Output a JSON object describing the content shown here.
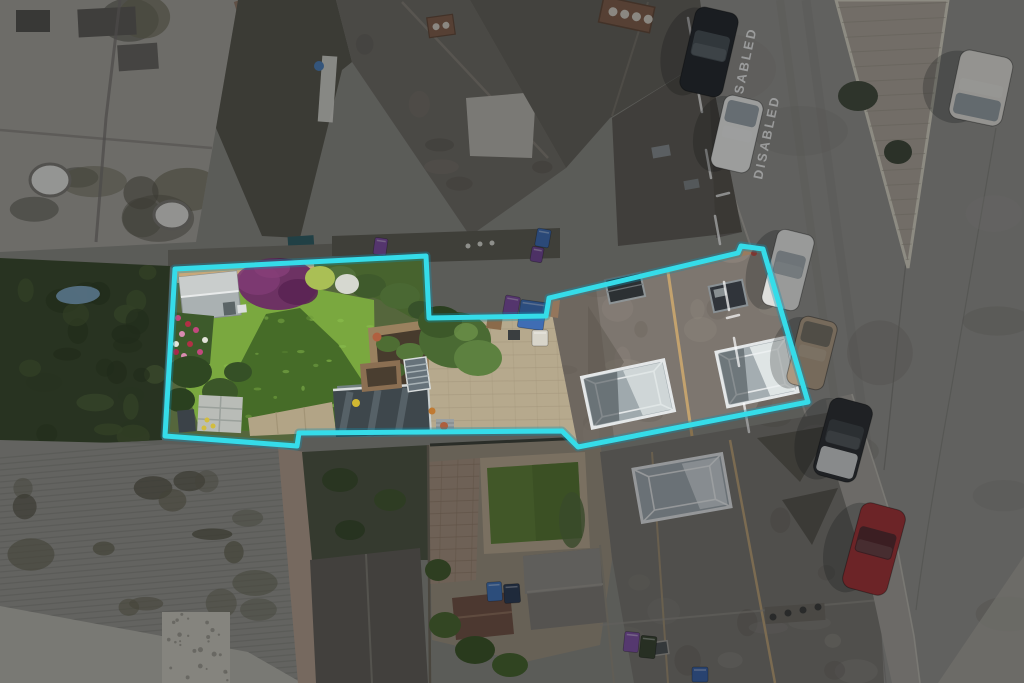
{
  "overlay": {
    "boundary_color": "#35dce9",
    "boundary_glow": "#128fae",
    "dim": "rgba(6,9,11,0.32)",
    "points": [
      [
        175,
        269
      ],
      [
        426,
        256
      ],
      [
        429,
        318
      ],
      [
        546,
        316
      ],
      [
        549,
        298
      ],
      [
        738,
        253
      ],
      [
        741,
        246
      ],
      [
        763,
        249
      ],
      [
        808,
        402
      ],
      [
        578,
        447
      ],
      [
        562,
        431
      ],
      [
        299,
        433
      ],
      [
        297,
        446
      ],
      [
        165,
        436
      ]
    ]
  },
  "palette": {
    "ground": "#84837d",
    "road": "#8d8b86",
    "island": "#a59d92",
    "flat_roof": "#9e9b94",
    "hedge": "#39482b",
    "barn": "#8f8e88",
    "lawn_sun": "#7aa83f",
    "lawn_shadow": "#3f6326",
    "roof_slate": "#7d766f",
    "se_roof": "#74716b",
    "purple_shrub": "#6d3263",
    "gravel": "#c8a87a",
    "alley_paving": "#b6a98d",
    "sidewalk": "#9c9992"
  },
  "road_markings": {
    "color": "rgba(255,255,255,0.75)",
    "texts": [
      {
        "label": "DISABLED",
        "x": 739,
        "y": 112,
        "rotate": -78
      },
      {
        "label": "DISABLED",
        "x": 762,
        "y": 180,
        "rotate": -78
      }
    ],
    "bay_dashes": [
      [
        688,
        18,
        693,
        46
      ],
      [
        697,
        84,
        702,
        112
      ],
      [
        706,
        150,
        711,
        178
      ],
      [
        715,
        216,
        720,
        244
      ],
      [
        724,
        282,
        729,
        310
      ],
      [
        734,
        338,
        739,
        366
      ],
      [
        744,
        404,
        749,
        432
      ],
      [
        717,
        196,
        729,
        193
      ],
      [
        727,
        318,
        739,
        315
      ]
    ]
  },
  "vehicles": [
    {
      "name": "black-suv",
      "cx": 709,
      "cy": 52,
      "w": 44,
      "h": 86,
      "rotate": 13,
      "body": "#24272b",
      "glass": "#4a5056",
      "glass_at": "mid"
    },
    {
      "name": "white-car",
      "cx": 737,
      "cy": 134,
      "w": 40,
      "h": 74,
      "rotate": 13,
      "body": "#e3e3e0",
      "glass": "#8d979c",
      "glass_at": "top"
    },
    {
      "name": "white-car-2",
      "cx": 788,
      "cy": 270,
      "w": 38,
      "h": 78,
      "rotate": 14,
      "body": "#dfdfdc",
      "glass": "#99a2a6",
      "glass_at": "mid"
    },
    {
      "name": "tan-van",
      "cx": 812,
      "cy": 353,
      "w": 38,
      "h": 70,
      "rotate": 14,
      "body": "#ab9880",
      "glass": "#6e6a5f",
      "glass_at": "top"
    },
    {
      "name": "dark-car-silver-bonnet",
      "cx": 843,
      "cy": 440,
      "w": 44,
      "h": 80,
      "rotate": 15,
      "body": "#2b2d30",
      "glass": "#3f4347",
      "glass_at": "mid",
      "hood": "#c6c8c8",
      "hood_at": "bottom"
    },
    {
      "name": "red-car",
      "cx": 874,
      "cy": 549,
      "w": 46,
      "h": 88,
      "rotate": 15,
      "body": "#9c3134",
      "glass": "#4f282c",
      "glass_at": "mid"
    },
    {
      "name": "white-van",
      "cx": 981,
      "cy": 88,
      "w": 54,
      "h": 70,
      "rotate": 12,
      "body": "#d7d5cf",
      "glass": "#8a9298",
      "glass_at": "bottom"
    }
  ],
  "bins": [
    {
      "name": "purple-bin-north",
      "x": 374,
      "y": 238,
      "w": 13,
      "h": 17,
      "rotate": 8,
      "color": "#7a4b9b"
    },
    {
      "name": "blue-bin-north",
      "x": 536,
      "y": 229,
      "w": 14,
      "h": 18,
      "rotate": 10,
      "color": "#3d68ac"
    },
    {
      "name": "purple-bin-north-2",
      "x": 531,
      "y": 247,
      "w": 12,
      "h": 15,
      "rotate": 10,
      "color": "#6f4590"
    },
    {
      "name": "purple-bin-plot",
      "x": 504,
      "y": 296,
      "w": 15,
      "h": 20,
      "rotate": 10,
      "color": "#7a4b9b"
    },
    {
      "name": "blue-bin-plot",
      "x": 519,
      "y": 301,
      "w": 26,
      "h": 28,
      "rotate": 8,
      "color": "#3f6db4"
    },
    {
      "name": "white-sack-plot",
      "x": 532,
      "y": 330,
      "w": 16,
      "h": 16,
      "rotate": 0,
      "color": "#d8d5ca"
    },
    {
      "name": "blue-bin-neighbour",
      "x": 487,
      "y": 582,
      "w": 15,
      "h": 19,
      "rotate": -4,
      "color": "#3f6eb0"
    },
    {
      "name": "navy-bin-neighbour",
      "x": 504,
      "y": 584,
      "w": 16,
      "h": 19,
      "rotate": -4,
      "color": "#2c3a52"
    },
    {
      "name": "purple-bin-se",
      "x": 624,
      "y": 632,
      "w": 15,
      "h": 20,
      "rotate": 6,
      "color": "#7b4f9e"
    },
    {
      "name": "green-bin-se",
      "x": 640,
      "y": 636,
      "w": 16,
      "h": 22,
      "rotate": 6,
      "color": "#37422f"
    },
    {
      "name": "blue-bin-se",
      "x": 692,
      "y": 667,
      "w": 16,
      "h": 15,
      "rotate": 0,
      "color": "#3a5f9f"
    }
  ]
}
